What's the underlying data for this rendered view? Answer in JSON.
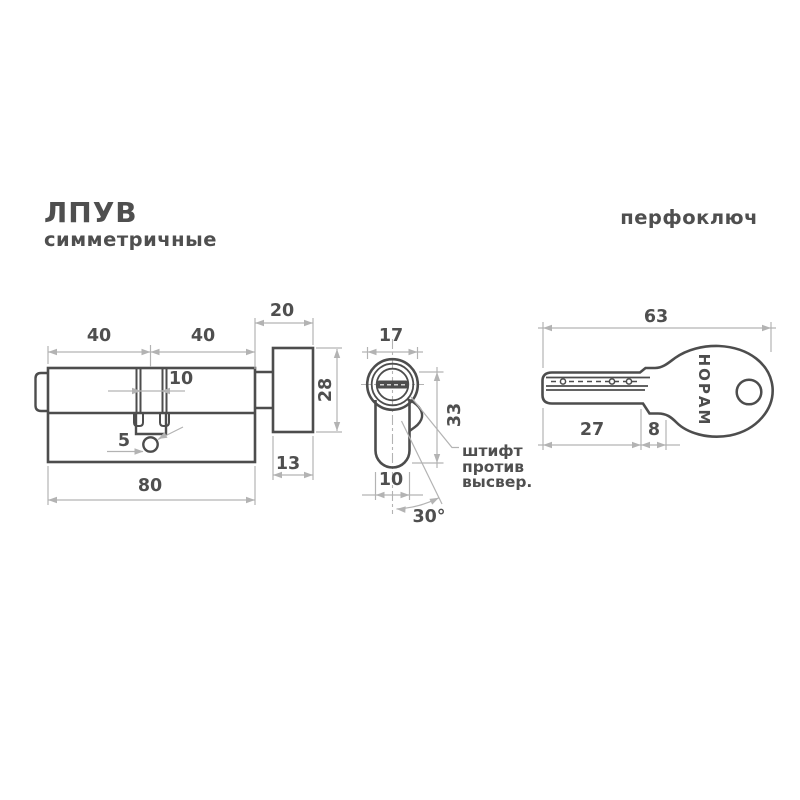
{
  "colors": {
    "background": "#ffffff",
    "line_dark": "#4d4d4d",
    "line_dimension": "#b3b3b3",
    "text": "#4f4f4f"
  },
  "header": {
    "series": "ЛПУВ",
    "subtitle": "симметричные",
    "key_type": "перфоключ"
  },
  "side_view": {
    "dims": {
      "left_half": "40",
      "right_half": "40",
      "knob_total": "20",
      "cam_width": "10",
      "screw_offset": "5",
      "body_length": "80",
      "knob_depth": "13",
      "knob_height": "28"
    }
  },
  "front_view": {
    "dims": {
      "face_diameter": "17",
      "profile_height": "33",
      "body_width": "10",
      "angle": "30°"
    },
    "note": {
      "line1": "штифт",
      "line2": "против",
      "line3": "высвер."
    }
  },
  "key_view": {
    "dims": {
      "total_length": "63",
      "blade_length": "27",
      "shoulder_width": "8"
    },
    "brand": "НОРАМ"
  }
}
